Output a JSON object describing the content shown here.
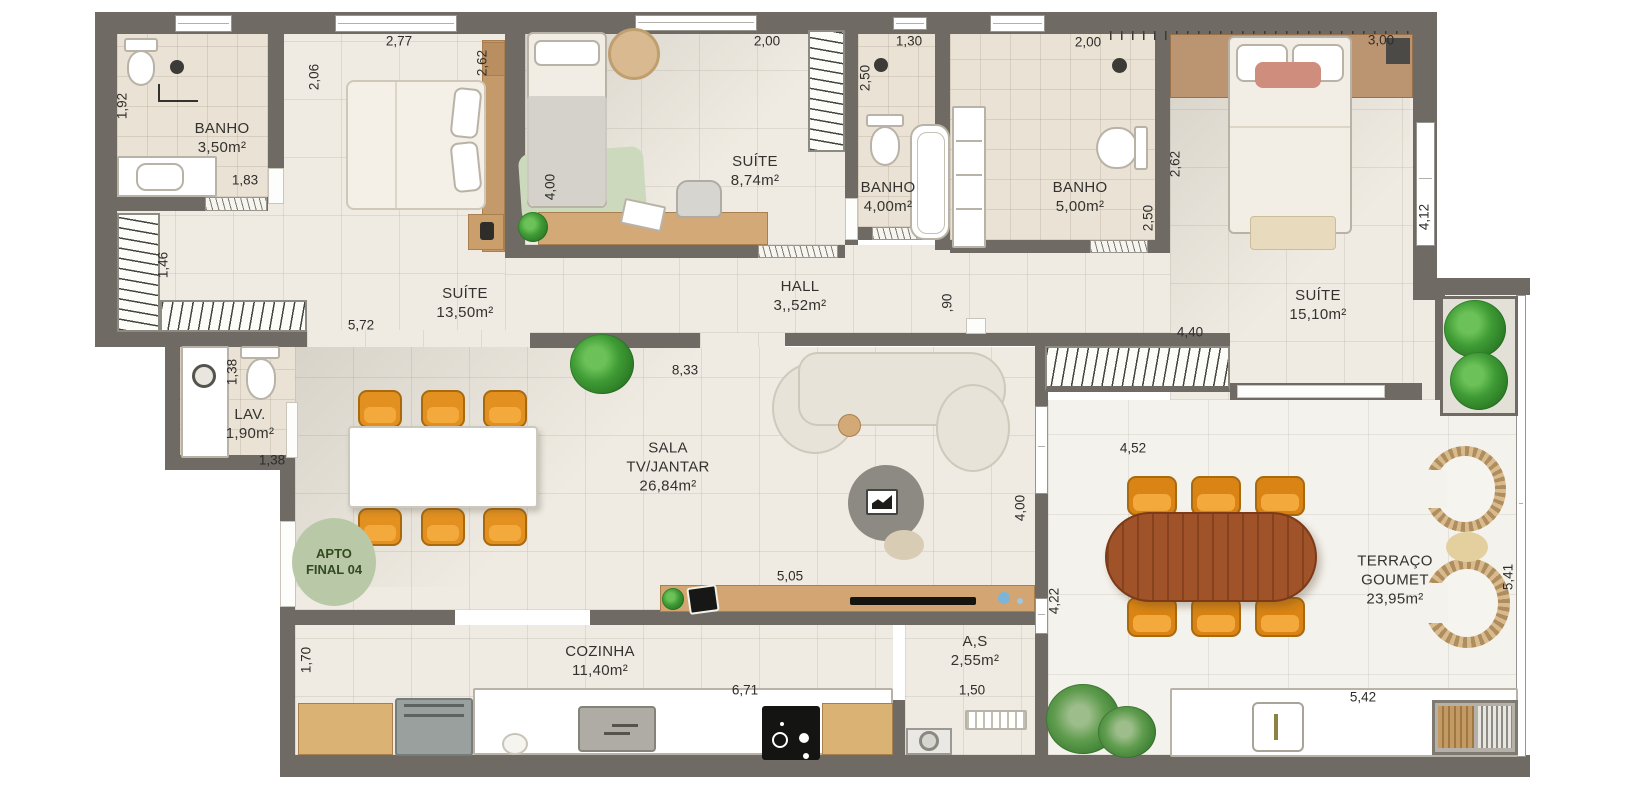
{
  "plan": {
    "badge": {
      "l1": "APTO",
      "l2": "FINAL 04"
    },
    "rooms": [
      {
        "id": "banho-suite1",
        "l1": "BANHO",
        "l2": "3,50m²"
      },
      {
        "id": "suite1",
        "l1": "SUÍTE",
        "l2": "13,50m²"
      },
      {
        "id": "suite2",
        "l1": "SUÍTE",
        "l2": "8,74m²"
      },
      {
        "id": "banho-suite2",
        "l1": "BANHO",
        "l2": "4,00m²"
      },
      {
        "id": "banho-suite3",
        "l1": "BANHO",
        "l2": "5,00m²"
      },
      {
        "id": "suite3",
        "l1": "SUÍTE",
        "l2": "15,10m²"
      },
      {
        "id": "hall",
        "l1": "HALL",
        "l2": "3,,52m²"
      },
      {
        "id": "lavabo",
        "l1": "LAV.",
        "l2": "1,90m²"
      },
      {
        "id": "sala",
        "l1": "SALA",
        "l2": "TV/JANTAR",
        "l3": "26,84m²"
      },
      {
        "id": "cozinha",
        "l1": "COZINHA",
        "l2": "11,40m²"
      },
      {
        "id": "area-servico",
        "l1": "A,S",
        "l2": "2,55m²"
      },
      {
        "id": "terraco",
        "l1": "TERRAÇO",
        "l2": "GOUMET",
        "l3": "23,95m²"
      }
    ],
    "dims": [
      {
        "t": "1,92"
      },
      {
        "t": "2,06"
      },
      {
        "t": "2,77"
      },
      {
        "t": "2,62"
      },
      {
        "t": "1,83"
      },
      {
        "t": "1,46"
      },
      {
        "t": "5,72"
      },
      {
        "t": "4,00"
      },
      {
        "t": "2,00"
      },
      {
        "t": "1,30"
      },
      {
        "t": "2,50"
      },
      {
        "t": "2,00"
      },
      {
        "t": "2,62"
      },
      {
        "t": "2,50"
      },
      {
        "t": "3,00"
      },
      {
        "t": "4,12"
      },
      {
        "t": ",90"
      },
      {
        "t": "4,40"
      },
      {
        "t": "8,33"
      },
      {
        "t": "1,38"
      },
      {
        "t": "1,38"
      },
      {
        "t": "4,52"
      },
      {
        "t": "4,00"
      },
      {
        "t": "4,22"
      },
      {
        "t": "5,05"
      },
      {
        "t": "5,41"
      },
      {
        "t": "1,70"
      },
      {
        "t": "6,71"
      },
      {
        "t": "1,50"
      },
      {
        "t": "5,42"
      }
    ],
    "colors": {
      "wall": "#6f6b64",
      "floor": "#efebe2",
      "bath_floor": "#eae2d4",
      "terrace_floor": "#f4f2ec",
      "wood": "#cb9f6b",
      "terrace_table": "#a05228",
      "chair_orange": "#e2901f",
      "plant_green": "#3f9b35",
      "badge_green": "#b9c9a8"
    }
  }
}
